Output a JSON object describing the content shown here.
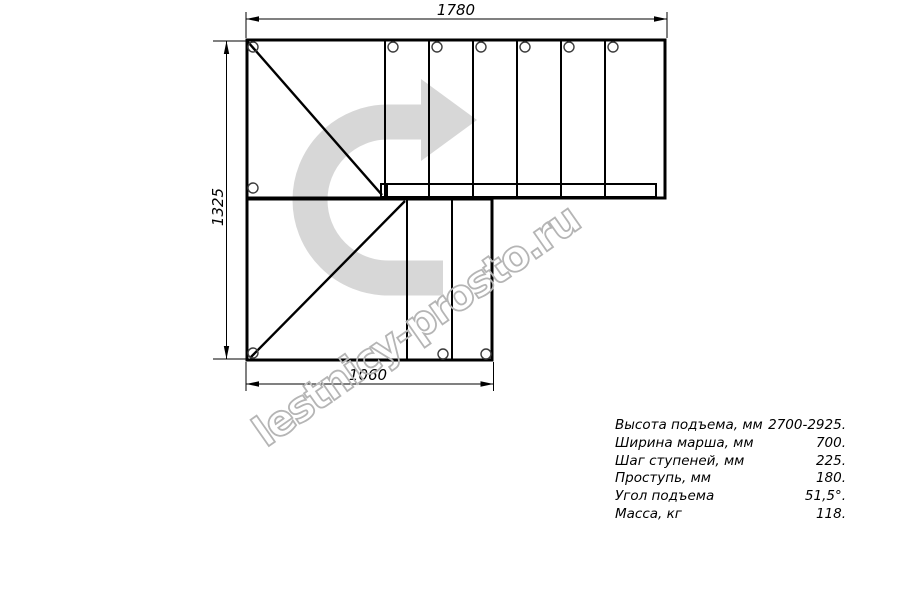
{
  "drawing": {
    "dimension_labels": {
      "top": "1780",
      "left": "1325",
      "bottom": "1060"
    },
    "watermark_text": "lestnicy-prosto.ru",
    "colors": {
      "line": "#000000",
      "direction_arrow": "#d7d7d7",
      "watermark": "#b5b5b5"
    }
  },
  "specs": {
    "rows": [
      {
        "label": "Высота подъема, мм",
        "value": "2700-2925."
      },
      {
        "label": "Ширина марша, мм",
        "value": "700."
      },
      {
        "label": "Шаг ступеней, мм",
        "value": "225."
      },
      {
        "label": "Проступь, мм",
        "value": "180."
      },
      {
        "label": "Угол подъема",
        "value": "51,5°."
      },
      {
        "label": "Масса, кг",
        "value": "118."
      }
    ]
  }
}
